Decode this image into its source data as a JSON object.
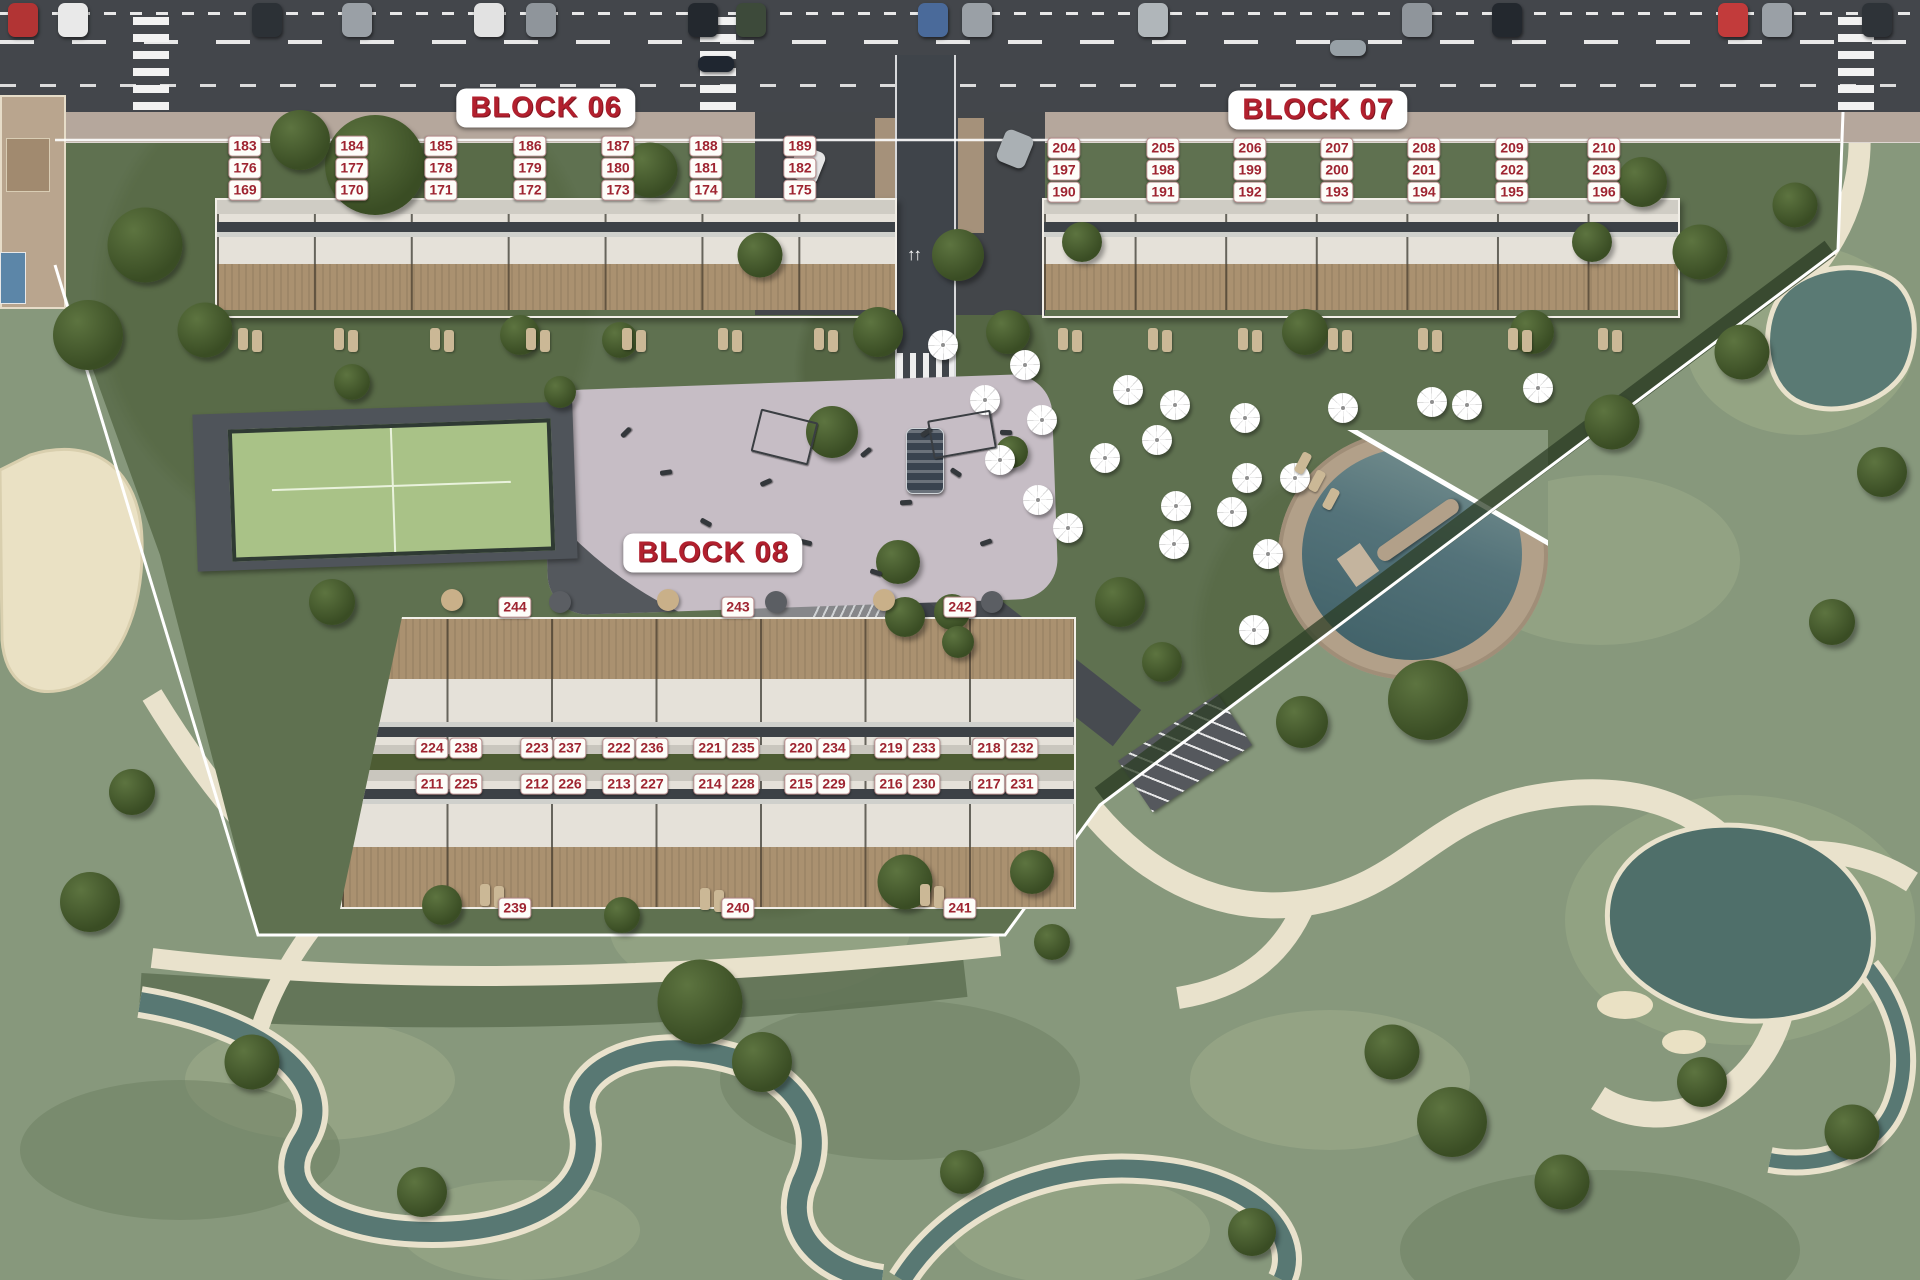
{
  "blocks": [
    {
      "id": "06",
      "title": "BLOCK 06",
      "title_pos": {
        "x": 546,
        "y": 108
      },
      "rows": [
        {
          "y": 146,
          "units": [
            "183",
            "184",
            "185",
            "186",
            "187",
            "188",
            "189"
          ],
          "xs": [
            245,
            352,
            441,
            530,
            618,
            706,
            800
          ]
        },
        {
          "y": 168,
          "units": [
            "176",
            "177",
            "178",
            "179",
            "180",
            "181",
            "182"
          ],
          "xs": [
            245,
            352,
            441,
            530,
            618,
            706,
            800
          ]
        },
        {
          "y": 190,
          "units": [
            "169",
            "170",
            "171",
            "172",
            "173",
            "174",
            "175"
          ],
          "xs": [
            245,
            352,
            441,
            530,
            618,
            706,
            800
          ]
        }
      ]
    },
    {
      "id": "07",
      "title": "BLOCK 07",
      "title_pos": {
        "x": 1318,
        "y": 110
      },
      "rows": [
        {
          "y": 148,
          "units": [
            "204",
            "205",
            "206",
            "207",
            "208",
            "209",
            "210"
          ],
          "xs": [
            1064,
            1163,
            1250,
            1337,
            1424,
            1512,
            1604
          ]
        },
        {
          "y": 170,
          "units": [
            "197",
            "198",
            "199",
            "200",
            "201",
            "202",
            "203"
          ],
          "xs": [
            1064,
            1163,
            1250,
            1337,
            1424,
            1512,
            1604
          ]
        },
        {
          "y": 192,
          "units": [
            "190",
            "191",
            "192",
            "193",
            "194",
            "195",
            "196"
          ],
          "xs": [
            1064,
            1163,
            1250,
            1337,
            1424,
            1512,
            1604
          ]
        }
      ]
    },
    {
      "id": "08",
      "title": "BLOCK 08",
      "title_pos": {
        "x": 713,
        "y": 553
      },
      "rows": [
        {
          "y": 607,
          "units": [
            "244",
            "243",
            "242"
          ],
          "xs": [
            515,
            738,
            960
          ]
        },
        {
          "y": 748,
          "units": [
            "224",
            "238",
            "223",
            "237",
            "222",
            "236",
            "221",
            "235",
            "220",
            "234",
            "219",
            "233",
            "218",
            "232"
          ],
          "xs": [
            432,
            466,
            537,
            570,
            619,
            652,
            710,
            743,
            801,
            834,
            891,
            924,
            989,
            1022
          ]
        },
        {
          "y": 784,
          "units": [
            "211",
            "225",
            "212",
            "226",
            "213",
            "227",
            "214",
            "228",
            "215",
            "229",
            "216",
            "230",
            "217",
            "231"
          ],
          "xs": [
            432,
            466,
            537,
            570,
            619,
            652,
            710,
            743,
            801,
            834,
            891,
            924,
            989,
            1022
          ]
        },
        {
          "y": 908,
          "units": [
            "239",
            "240",
            "241"
          ],
          "xs": [
            515,
            738,
            960
          ]
        }
      ]
    }
  ],
  "colors": {
    "label_text": "#9e2430",
    "label_bg": "#fdfdf9",
    "title_text": "#b2202e"
  }
}
